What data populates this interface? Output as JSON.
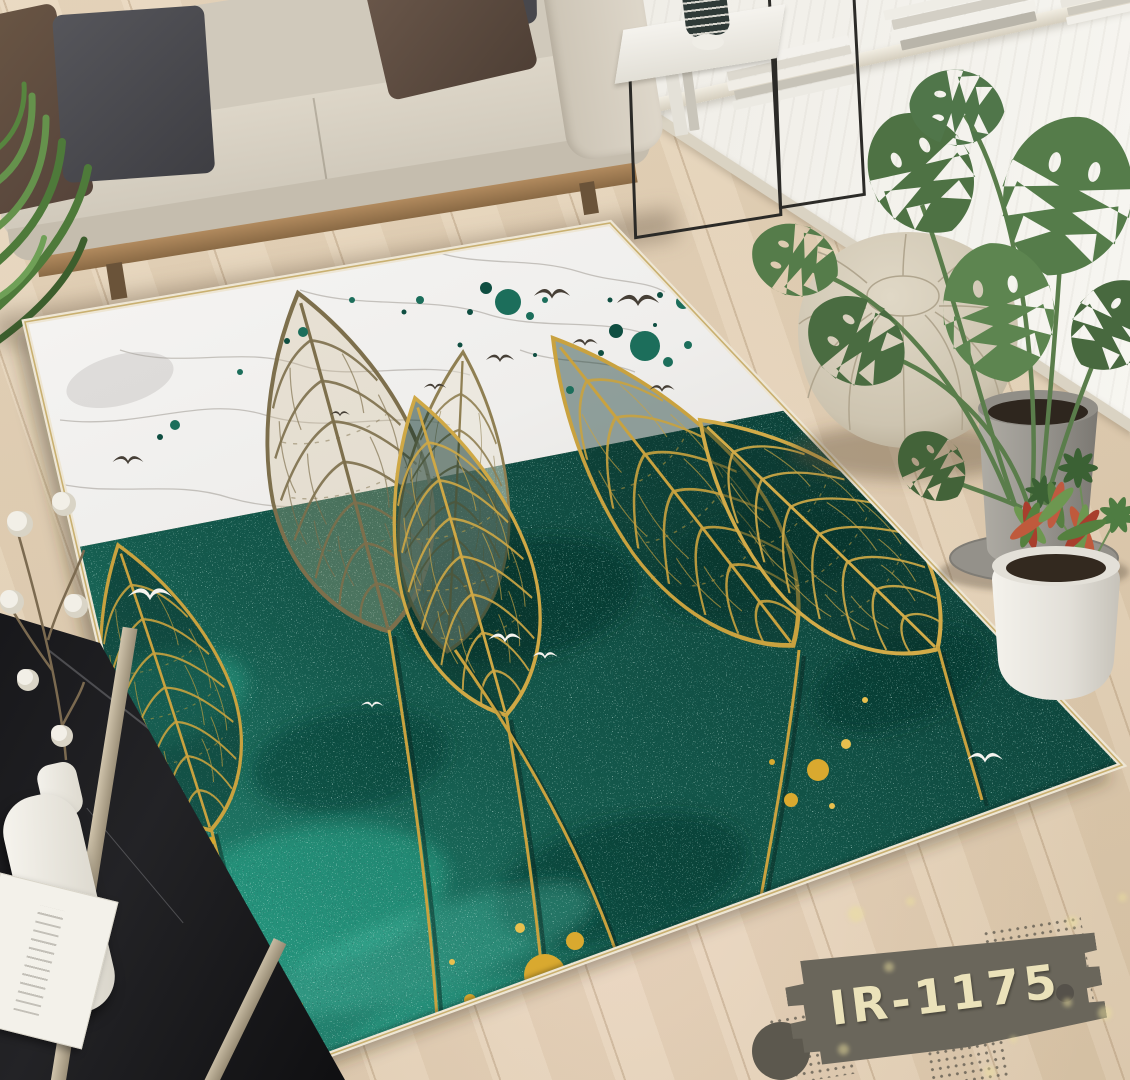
{
  "product_photo": {
    "description": "Living room scene with an emerald green and white marble area rug featuring gold skeleton leaves, white birds and gold paint splatters",
    "label": {
      "code": "IR-1175"
    },
    "palette": {
      "rug_teal": "#0f4a40",
      "rug_teal_light": "#2ea98e",
      "rug_marble": "#f3f2ef",
      "rug_gold": "#c9a23f",
      "rug_trim": "#eee6d4",
      "gold_splatter": "#d9a92f",
      "floor_wood": "#dfccb1",
      "sofa_fabric": "#d3ccbe",
      "pouf_leather": "#d5ccb9",
      "label_bg": "#6a665b",
      "label_text": "#ebe2ba",
      "plant_green": "#557c4a"
    },
    "objects": [
      "beige fabric sofa",
      "throw pillows",
      "fern plant",
      "black metal side tables",
      "striped vase",
      "window sill with books",
      "ribbed wall panel",
      "leaf skeleton area rug",
      "white bird motifs",
      "gold paint splatters",
      "moroccan pouf",
      "monstera plant in concrete pot",
      "schefflera plant",
      "red-green plant in white pot",
      "black marble coffee table",
      "white ceramic vase",
      "cotton branch",
      "magazine",
      "product code label",
      "halftone dot pattern"
    ]
  }
}
